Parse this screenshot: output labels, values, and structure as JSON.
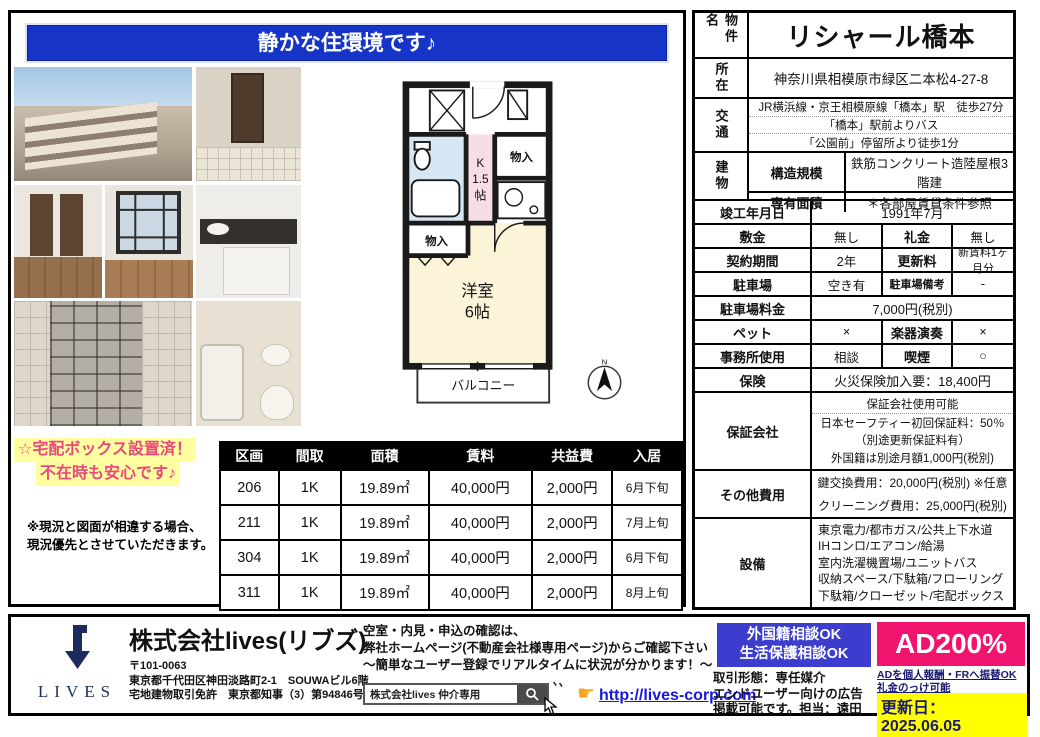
{
  "banner": {
    "text": "静かな住環境です♪"
  },
  "floorplan": {
    "closet_top_right": "物入",
    "kitchen_line1": "K",
    "kitchen_line2": "1.5",
    "kitchen_line3": "帖",
    "closet_left": "物入",
    "room_line1": "洋室",
    "room_line2": "6帖",
    "balcony": "バルコニー",
    "compass": "N"
  },
  "notes": {
    "highlight_line1": "☆宅配ボックス設置済！",
    "highlight_line2": "不在時も安心です♪",
    "disclaimer_line1": "※現況と図面が相違する場合、",
    "disclaimer_line2": "現況優先とさせていただきます。"
  },
  "units": {
    "headers": [
      "区画",
      "間取",
      "面積",
      "賃料",
      "共益費",
      "入居"
    ],
    "rows": [
      [
        "206",
        "1K",
        "19.89㎡",
        "40,000円",
        "2,000円",
        "6月下旬"
      ],
      [
        "211",
        "1K",
        "19.89㎡",
        "40,000円",
        "2,000円",
        "7月上旬"
      ],
      [
        "304",
        "1K",
        "19.89㎡",
        "40,000円",
        "2,000円",
        "6月下旬"
      ],
      [
        "311",
        "1K",
        "19.89㎡",
        "40,000円",
        "2,000円",
        "8月上旬"
      ]
    ]
  },
  "details": {
    "property_name_label": "物件名",
    "property_name": "リシャール橋本",
    "address_label": "所在",
    "address": "神奈川県相模原市緑区二本松4-27-8",
    "access_label": "交通",
    "access_line1": "JR横浜線・京王相模原線「橋本」駅　徒歩27分",
    "access_line2": "「橋本」駅前よりバス",
    "access_line3": "「公園前」停留所より徒歩1分",
    "building_label": "建物",
    "structure_label": "構造規模",
    "structure": "鉄筋コンクリート造陸屋根3階建",
    "area_label": "専有面積",
    "area": "＊各部屋賃貸条件参照",
    "completion_label": "竣工年月日",
    "completion": "1991年7月",
    "deposit_label": "敷金",
    "deposit": "無し",
    "key_money_label": "礼金",
    "key_money": "無し",
    "contract_label": "契約期間",
    "contract": "2年",
    "renewal_label": "更新料",
    "renewal": "新賃料1ヶ月分",
    "parking_label": "駐車場",
    "parking": "空き有",
    "parking_note_label": "駐車場備考",
    "parking_note": "-",
    "parking_fee_label": "駐車場料金",
    "parking_fee": "7,000円(税別)",
    "pet_label": "ペット",
    "pet": "×",
    "instrument_label": "楽器演奏",
    "instrument": "×",
    "office_label": "事務所使用",
    "office": "相談",
    "smoking_label": "喫煙",
    "smoking": "○",
    "insurance_label": "保険",
    "insurance": "火災保険加入要：18,400円",
    "guarantor_label": "保証会社",
    "guarantor_head": "保証会社使用可能",
    "guarantor_line1": "日本セーフティー初回保証料：50％",
    "guarantor_line2": "（別途更新保証料有）",
    "guarantor_line3": "外国籍は別途月額1,000円(税別)",
    "other_fees_label": "その他費用",
    "other_fees_line1": "鍵交換費用：20,000円(税別) ※任意",
    "other_fees_line2": "クリーニング費用：25,000円(税別)",
    "equipment_label": "設備",
    "equipment_line1": "東京電力/都市ガス/公共上下水道",
    "equipment_line2": "IHコンロ/エアコン/給湯",
    "equipment_line3": "室内洗濯機置場/ユニットバス",
    "equipment_line4": "収納スペース/下駄箱/フローリング",
    "equipment_line5": "下駄箱/クローゼット/宅配ボックス"
  },
  "footer": {
    "logo_text": "LIVES",
    "company_name": "株式会社lives(リブズ)",
    "postal": "〒101-0063",
    "address1": "東京都千代田区神田淡路町2-1　SOUWAビル6階",
    "license": "宅地建物取引免許　東京都知事（3）第94846号",
    "info_line1": "空室・内見・申込の確認は、",
    "info_line2": "弊社ホームページ(不動産会社様専用ページ)からご確認下さい",
    "info_line3": "～簡単なユーザー登録でリアルタイムに状況が分かります！～",
    "search_text": "株式会社lives 仲介専用",
    "finger": "☛",
    "url": "http://lives-corp.com",
    "consult_line1": "外国籍相談OK",
    "consult_line2": "生活保護相談OK",
    "deal_line1": "取引形態：専任媒介",
    "deal_line2": "エンドユーザー向けの広告",
    "deal_line3": "掲載可能です。担当：遠田",
    "ad_rate": "AD200%",
    "ad_note1": "ADを個人報酬・FRへ振替OK",
    "ad_note2": "礼金のっけ可能",
    "updated": "更新日：2025.06.05"
  },
  "colors": {
    "banner_blue": "#1634c8",
    "consult_blue": "#3c3ccf",
    "ad_pink": "#f0146e",
    "link_blue": "#1616e0",
    "navy": "#1c2a5e",
    "highlight_yellow": "#ffffa0",
    "highlight_pink": "#e8487e",
    "update_yellow": "#ffff00",
    "bath_blue": "#d6e7f3",
    "kitchen_pink": "#f7dde6",
    "room_cream": "#fcf4d9"
  }
}
